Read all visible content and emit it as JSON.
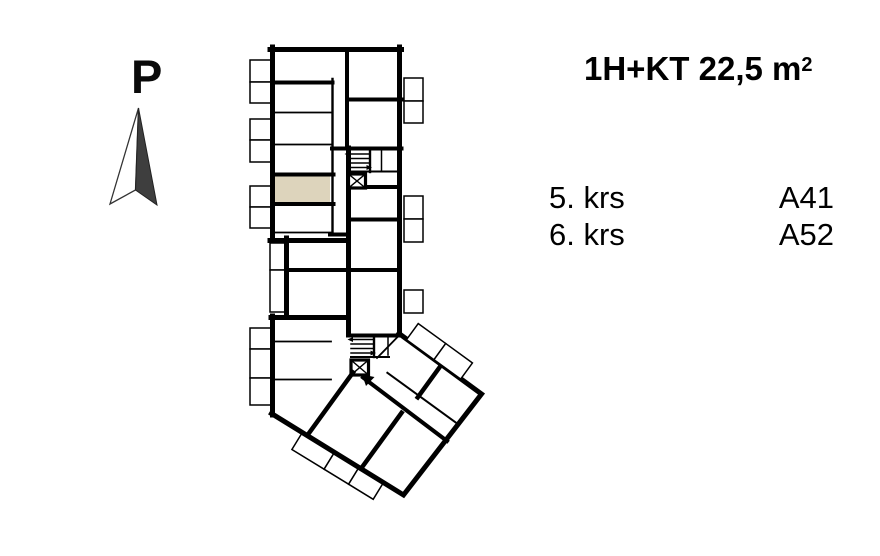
{
  "north_indicator": {
    "label": "P"
  },
  "unit_info": {
    "title": "1H+KT 22,5 m",
    "title_superscript": "2"
  },
  "floors": [
    {
      "floor": "5. krs",
      "apartment": "A41"
    },
    {
      "floor": "6. krs",
      "apartment": "A52"
    }
  ],
  "colors": {
    "highlight_room": "#ddd4bc",
    "walls": "#000000",
    "arrow_dark": "#3e3e3e"
  }
}
